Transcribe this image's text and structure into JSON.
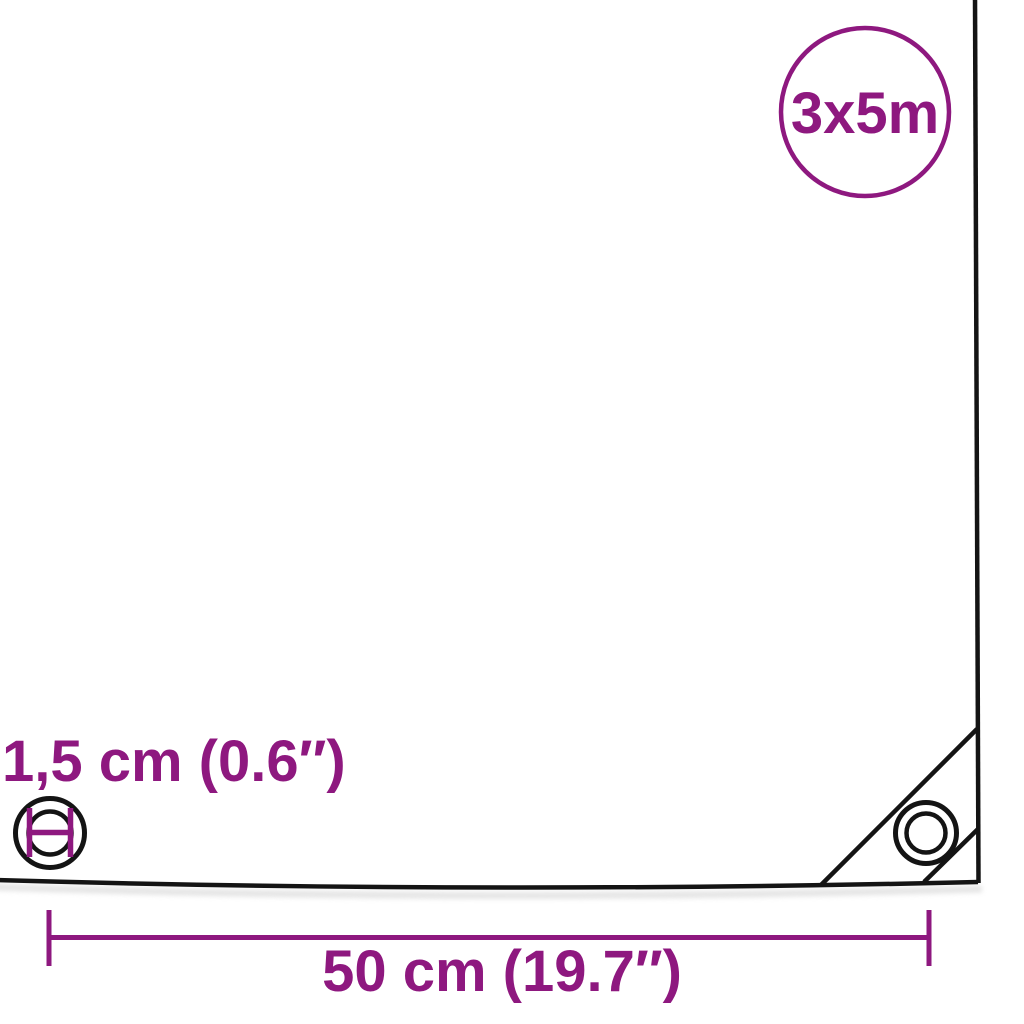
{
  "colors": {
    "accent": "#8e187f",
    "line": "#141414",
    "background": "#ffffff",
    "shadow": "#dcdcdc"
  },
  "size_badge": {
    "label": "3x5m"
  },
  "labels": {
    "grommet_diameter": "1,5 cm (0.6″)",
    "grommet_spacing": "50 cm (19.7″)"
  },
  "icons": {
    "edge_grommet": "circle-with-diameter-marker",
    "corner_grommet": "double-circle-eyelet"
  }
}
